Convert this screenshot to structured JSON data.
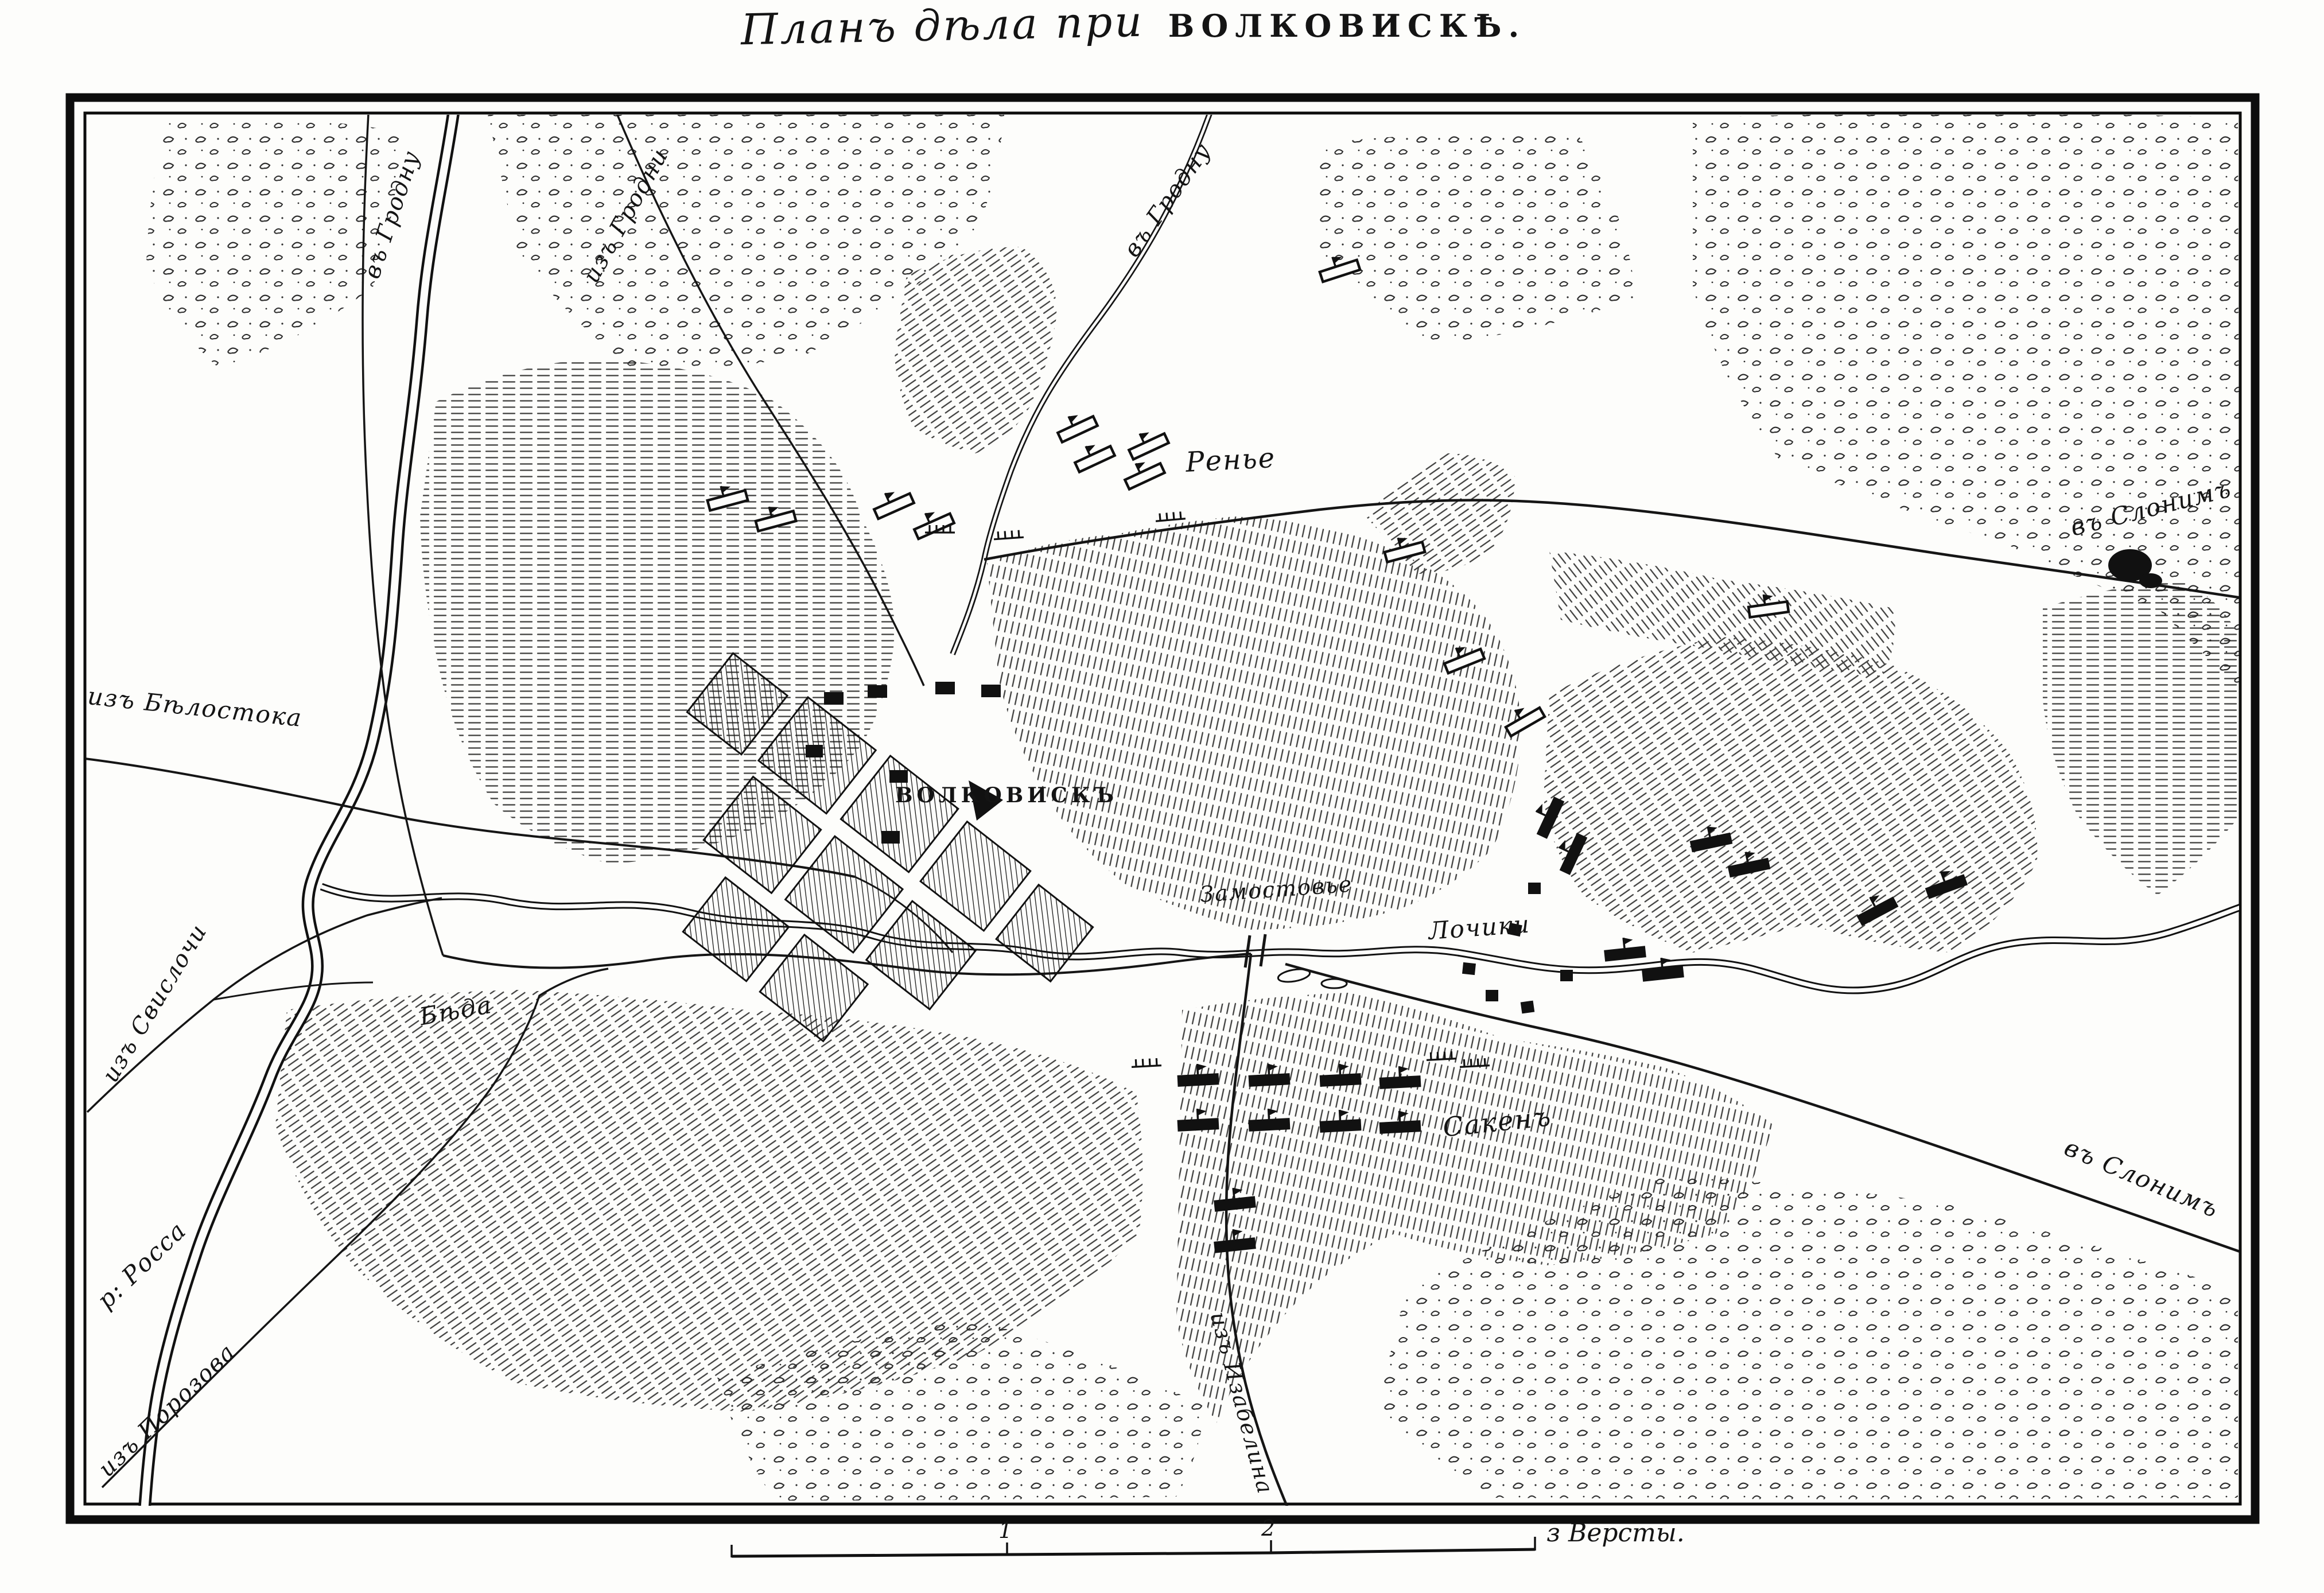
{
  "title": {
    "script": "Планъ дѣла при",
    "caps": "ВОЛКОВИСКѢ."
  },
  "labels": {
    "to_grodno_left": "въ Гродну",
    "from_grodno": "изъ Гродни",
    "to_grodno_mid": "въ Гродну",
    "reynier": "Ренье",
    "to_slonim_ne": "въ Слонимъ",
    "from_bialystok": "изъ Бѣлостока",
    "volkovysk": "ВОЛКОВИСКЪ",
    "zamost": "Замостовье",
    "lochiki": "Лочики",
    "bieda": "Бѣда",
    "from_svisloch": "изъ Свислочи",
    "rossa_river": "р: Росса",
    "from_porozovo": "изъ Порозова",
    "sacken": "Сакенъ",
    "from_izabelin": "изъ Изабелина",
    "to_slonim_se": "въ Слонимъ"
  },
  "scale": {
    "tick1": "1",
    "tick2": "2",
    "unit": "з Версты."
  },
  "colors": {
    "ink": "#141414",
    "paper": "#fdfdfb"
  }
}
